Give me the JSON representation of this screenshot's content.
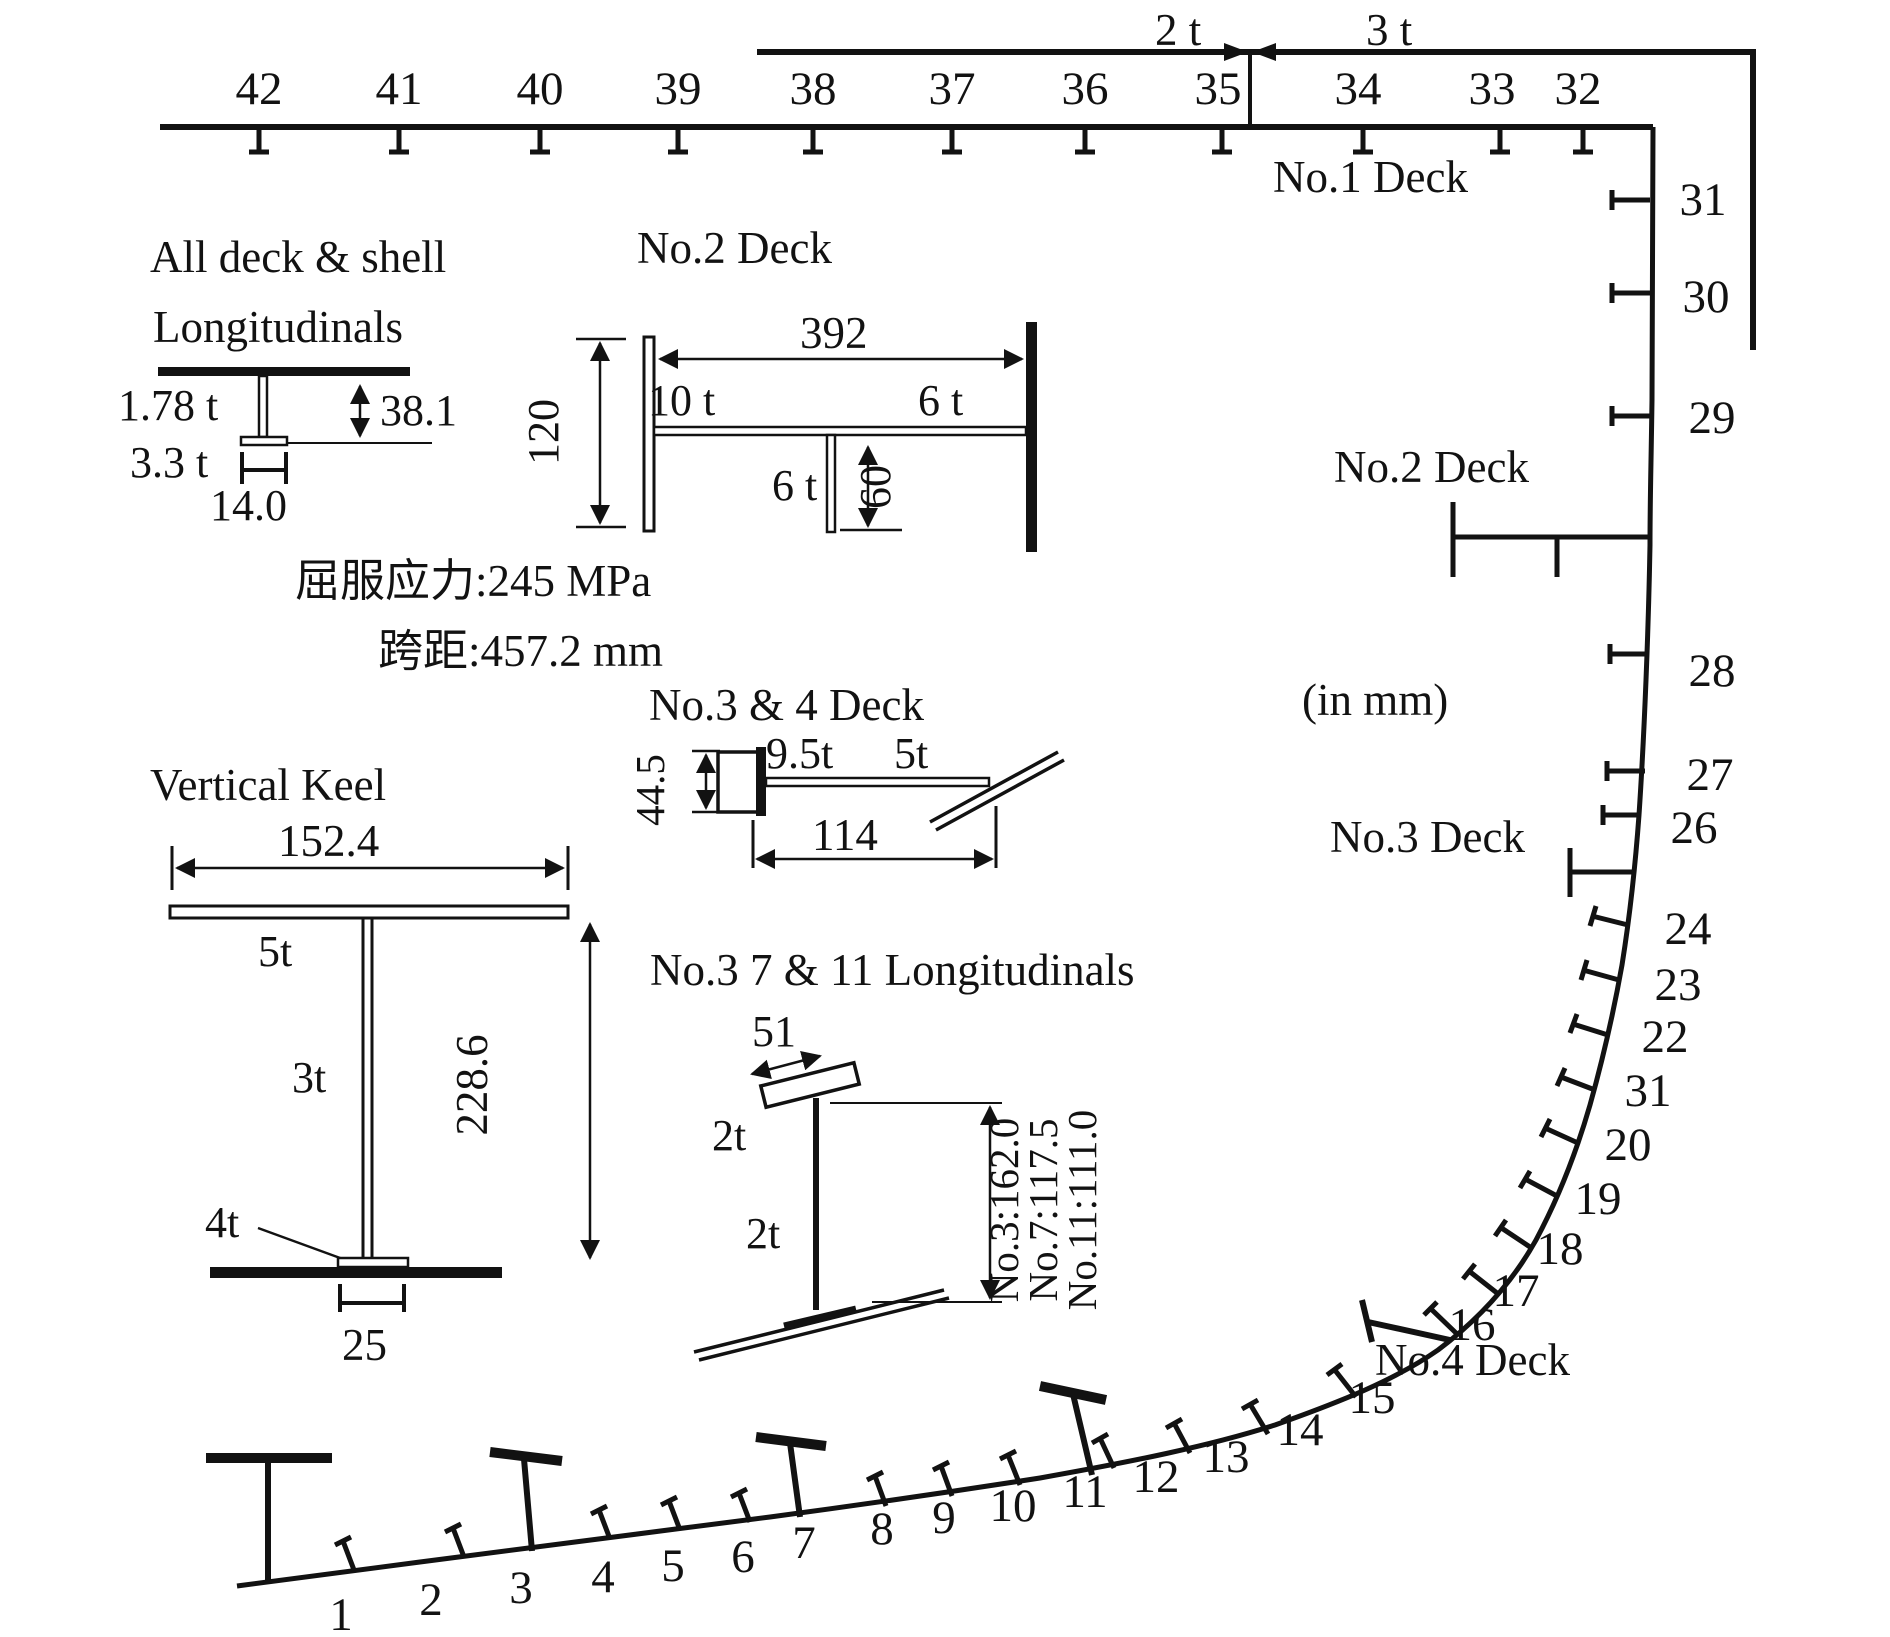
{
  "meta": {
    "units_note": "(in mm)"
  },
  "decks": {
    "no1": "No.1 Deck",
    "no2": "No.2 Deck",
    "no3": "No.3 Deck",
    "no4": "No.4 Deck"
  },
  "plating": {
    "left": "2 t",
    "right": "3 t"
  },
  "notes": {
    "yield_stress": "屈服应力:245 MPa",
    "span": "跨距:457.2 mm"
  },
  "frames": {
    "top": [
      "42",
      "41",
      "40",
      "39",
      "38",
      "37",
      "36",
      "35",
      "34",
      "33",
      "32"
    ],
    "side": [
      "31",
      "30",
      "29",
      "28",
      "27",
      "26"
    ],
    "bilge": [
      "24",
      "23",
      "22",
      "31",
      "20",
      "19",
      "18",
      "17",
      "16"
    ],
    "bottom": [
      "15",
      "14",
      "13",
      "12",
      "11",
      "10",
      "9",
      "8",
      "7",
      "6",
      "5",
      "4",
      "3",
      "2",
      "1"
    ]
  },
  "details": {
    "longitudinals": {
      "title_line1": "All deck & shell",
      "title_line2": "Longitudinals",
      "web_thickness": "1.78 t",
      "flange_thickness": "3.3 t",
      "flange_width": "14.0",
      "web_depth": "38.1"
    },
    "no2_deck": {
      "title": "No.2 Deck",
      "span": "392",
      "web_depth": "120",
      "plate_thickness": "10 t",
      "flange_thickness": "6 t",
      "stiffener_thickness": "6 t",
      "stiffener_depth": "60"
    },
    "no34_deck": {
      "title": "No.3 & 4 Deck",
      "web_depth": "44.5",
      "web_thickness": "9.5t",
      "plate_thickness": "5t",
      "flange_width": "114"
    },
    "vertical_keel": {
      "title": "Vertical Keel",
      "flange_width": "152.4",
      "flange_thickness": "5t",
      "web_thickness": "3t",
      "web_depth": "228.6",
      "bottom_thickness": "4t",
      "foot_width": "25"
    },
    "no3_7_11": {
      "title": "No.3 7 & 11 Longitudinals",
      "flange_width": "51",
      "flange_thickness": "2t",
      "web_thickness": "2t",
      "depths": [
        "No.3:162.0",
        "No.7:117.5",
        "No.11:111.0"
      ]
    }
  }
}
